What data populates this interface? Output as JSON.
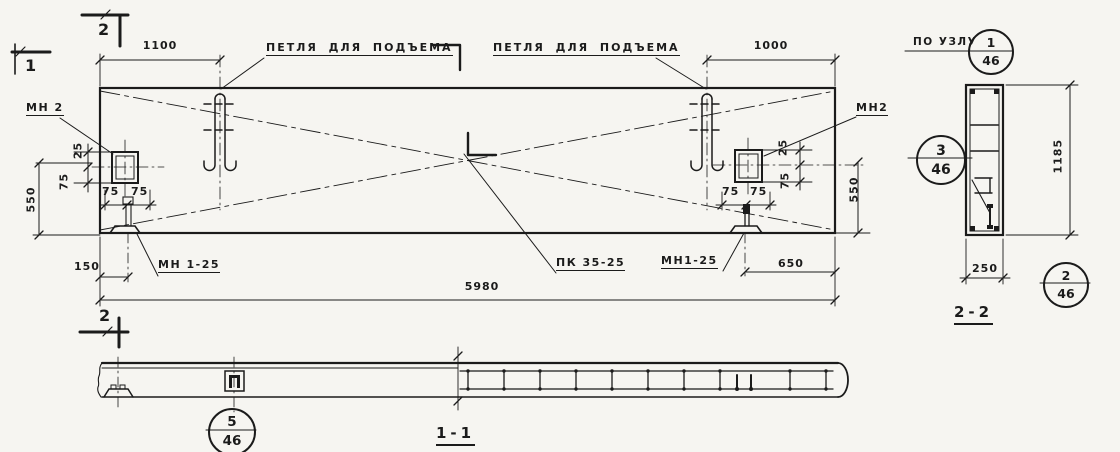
{
  "plan": {
    "section_mark_1": "1",
    "section_mark_2": "2",
    "lifting_loop_label": "ПЕТЛЯ ДЛЯ ПОДЪЕМА",
    "embed_label_left": "МН 2",
    "embed_label_right": "МН2",
    "anchor_label_left": "МН 1-25",
    "anchor_label_right": "МН1-25",
    "panel_mark_label": "ПК 35-25",
    "dims": {
      "d1100": "1100",
      "d1000": "1000",
      "d5980": "5980",
      "d150": "150",
      "d650": "650",
      "d550": "550",
      "d25": "25",
      "d75": "75"
    }
  },
  "section_2_2": {
    "title": "2-2",
    "detail_note": "ПО УЗЛУ",
    "dims": {
      "d1185": "1185",
      "d250": "250"
    },
    "callouts": {
      "top": {
        "num": "1",
        "den": "46"
      },
      "left": {
        "num": "3",
        "den": "46"
      },
      "bottom": {
        "num": "2",
        "den": "46"
      }
    }
  },
  "section_1_1": {
    "title": "1-1",
    "callout": {
      "num": "5",
      "den": "46"
    }
  }
}
